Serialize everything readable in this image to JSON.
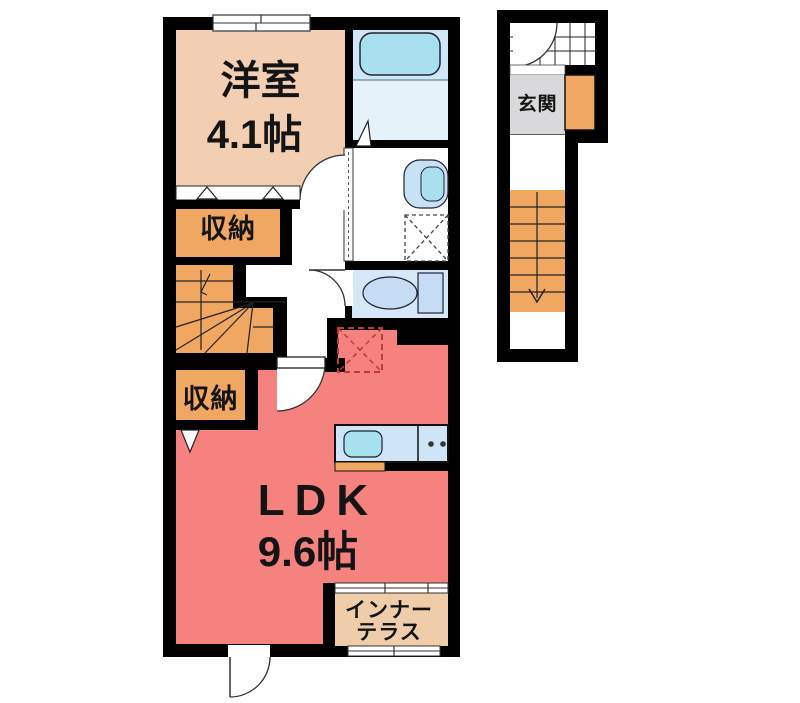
{
  "floorplan": {
    "type": "apartment-floor-plan",
    "western_room": {
      "name": "洋室",
      "size": "4.1帖"
    },
    "storage_upper": {
      "label": "収納"
    },
    "storage_lower": {
      "label": "収納"
    },
    "ldk": {
      "name": "LDK",
      "size": "9.6帖"
    },
    "inner_terrace": {
      "label_line1": "インナー",
      "label_line2": "テラス"
    },
    "entrance": {
      "label": "玄関"
    },
    "fixtures": {
      "bathtub": "bathtub-icon",
      "washbasin": "washbasin-icon",
      "washing_machine_space": "washing-machine-space-icon",
      "toilet": "toilet-icon",
      "kitchen": "kitchen-counter-sink-stove-icon",
      "refrigerator_space": "refrigerator-space-icon",
      "internal_staircase": "winder-staircase-icon",
      "entry_staircase": "straight-staircase-icon"
    },
    "colors": {
      "wall": "#000000",
      "room": "#f2cfb2",
      "storage": "#f0a761",
      "stairs": "#f0a761",
      "ldk": "#f5827e",
      "terrace": "#efcdaa",
      "entrance": "#d9d9db",
      "bath": "#cfe7f6",
      "bathlight": "#e6f2fa",
      "toiletroom": "#d6e7f7",
      "fixture": "#a9e0f0",
      "fixture2": "#c5dcf4",
      "counter": "#cfe4f7",
      "dash": "#c03a32"
    }
  }
}
